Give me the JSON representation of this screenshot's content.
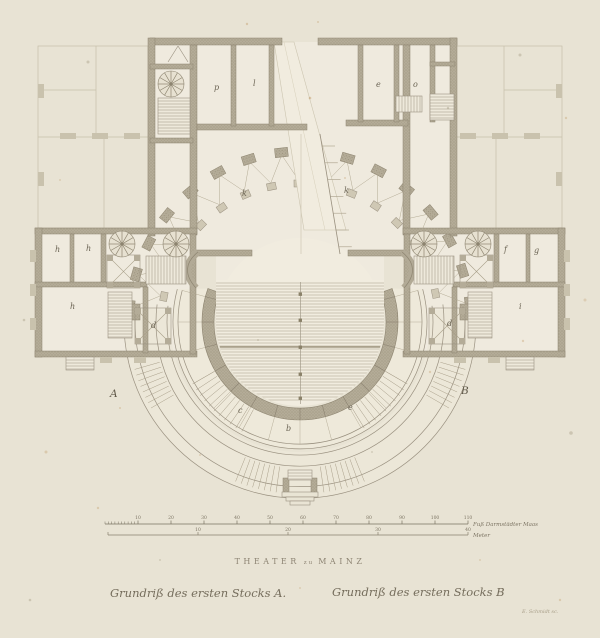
{
  "artwork": {
    "title_parts": [
      "THEATER",
      "zu",
      "MAINZ"
    ],
    "caption_left": "Grundriß des ersten Stocks A.",
    "caption_right": "Grundriß des ersten Stocks B",
    "signature": "E. Schmidt sc.",
    "plate_letter_left": "A",
    "plate_letter_right": "B"
  },
  "scale_bar": {
    "feet_ticks": [
      "10",
      "20",
      "30",
      "40",
      "50",
      "60",
      "70",
      "80",
      "90",
      "100",
      "110"
    ],
    "feet_unit": "Fuß Darmstädter Maas",
    "meter_ticks": [
      "10",
      "20",
      "30",
      "40"
    ],
    "meter_unit": "Meter"
  },
  "room_labels": {
    "stage_left": "k",
    "stage_right": "k",
    "rear_room_1": "p",
    "rear_room_2": "l",
    "rear_room_3": "e",
    "rear_room_4": "o",
    "left_room_1": "h",
    "left_room_2": "h",
    "left_room_big": "h",
    "left_shaft": "d",
    "right_room_1": "f",
    "right_room_2": "g",
    "right_room_big": "i",
    "right_shaft": "d",
    "parterre": "b",
    "corridor_left": "c",
    "corridor_right": "e"
  },
  "palette": {
    "paper": "#e8e3d4",
    "ink": "#6d6656",
    "wall_fill": "#b4ac98"
  }
}
